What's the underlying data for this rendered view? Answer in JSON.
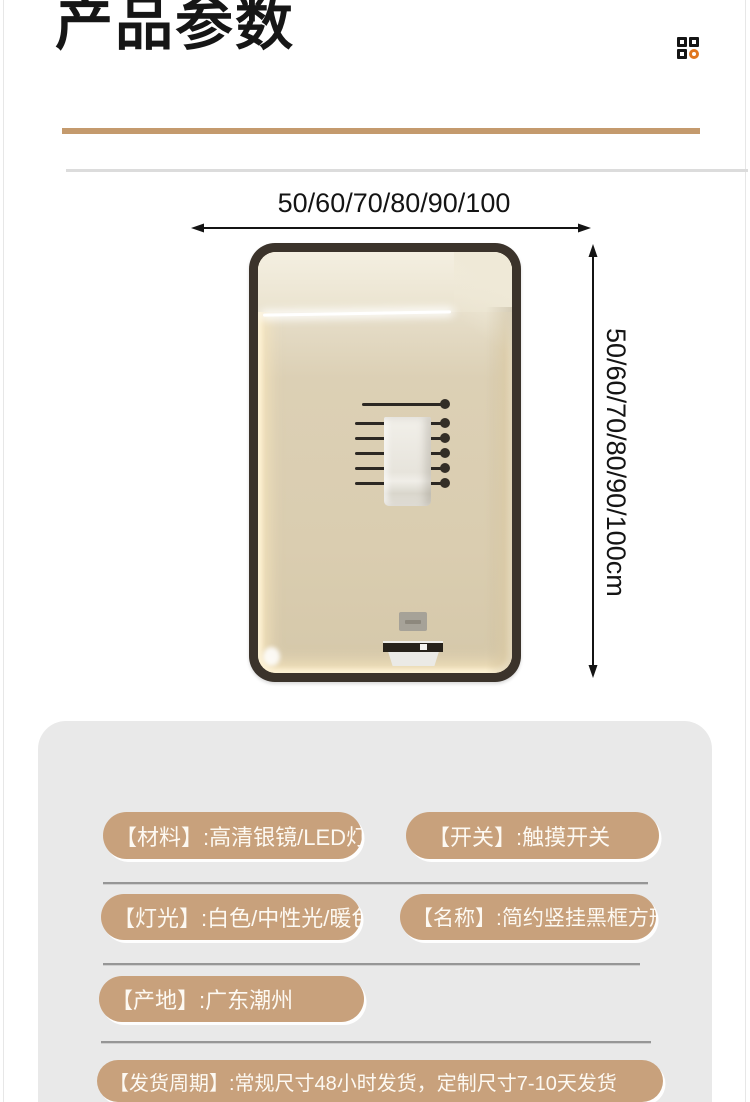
{
  "header": {
    "title": "产品参数"
  },
  "corner_icon": {
    "name": "grid-scan-icon"
  },
  "diagram": {
    "width_label": "50/60/70/80/90/100",
    "height_label": "50/60/70/80/90/100cm",
    "product": "LED黑框方形浴室镜"
  },
  "params": {
    "rows": [
      {
        "pills": [
          "【材料】:高清银镜/LED灯",
          "【开关】:触摸开关"
        ]
      },
      {
        "pills": [
          "【灯光】:白色/中性光/暖色",
          "【名称】:简约竖挂黑框方形"
        ]
      },
      {
        "pills": [
          "【产地】:广东潮州"
        ]
      },
      {
        "pills": [
          "【发货周期】:常规尺寸48小时发货，定制尺寸7-10天发货"
        ]
      }
    ]
  },
  "colors": {
    "accent_bar": "#c49a6d",
    "pill": "#c8a17c",
    "pill_text": "#fdf9f2",
    "panel_bg": "#e9e9e9",
    "icon_orange": "#e0761f",
    "arrow": "#141414",
    "mirror_frame": "#3b332b"
  }
}
